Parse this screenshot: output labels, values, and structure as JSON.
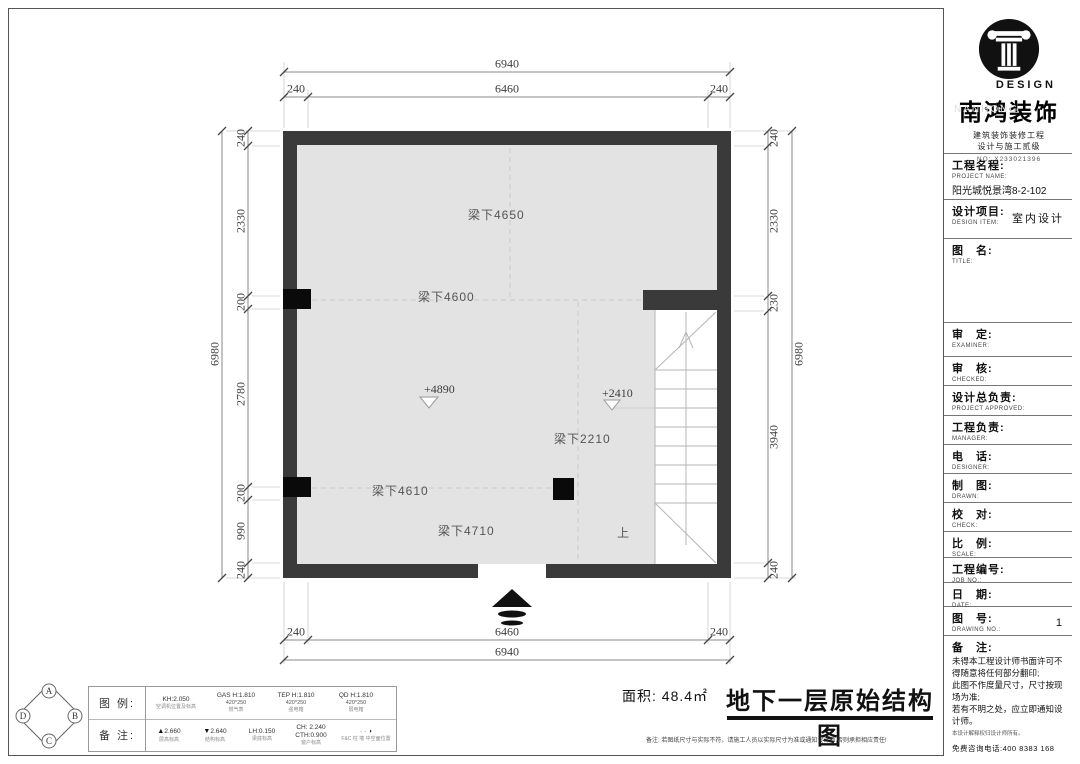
{
  "plan": {
    "beams": {
      "b4650": "梁下4650",
      "b4600": "梁下4600",
      "b2210": "梁下2210",
      "b4610": "梁下4610",
      "b4710": "梁下4710"
    },
    "elevations": {
      "e4890": "+4890",
      "e2410": "+2410"
    },
    "stair_up": "上",
    "dims": {
      "top": {
        "overall": "6940",
        "parts": [
          "240",
          "6460",
          "240"
        ]
      },
      "bottom": {
        "overall": "6940",
        "parts": [
          "240",
          "6460",
          "240"
        ]
      },
      "left": {
        "overall": "6980",
        "parts": [
          "240",
          "2330",
          "200",
          "2780",
          "200",
          "990",
          "240"
        ]
      },
      "right": {
        "overall": "6980",
        "parts": [
          "240",
          "2330",
          "230",
          "3940",
          "240"
        ]
      }
    },
    "colors": {
      "wall": "#3a3a3a",
      "floor": "#e3e3e3"
    }
  },
  "axis_marker": {
    "top": "A",
    "right": "B",
    "bottom": "C",
    "left": "D"
  },
  "legend": {
    "row1_label": "图 例:",
    "row2_label": "备 注:",
    "items_row1": [
      {
        "value": "KH:2.050",
        "size": "",
        "caption": "空调机位置及标高"
      },
      {
        "value": "GAS H:1.810",
        "size": "420*250",
        "caption": "燃气表"
      },
      {
        "value": "TEP H:1.810",
        "size": "420*250",
        "caption": "强电箱"
      },
      {
        "value": "QD H:1.810",
        "size": "420*250",
        "caption": "弱电箱"
      }
    ],
    "items_row2": [
      {
        "icon": "▲",
        "value": "2.660",
        "caption": "层高标高"
      },
      {
        "icon": "▼",
        "value": "2.640",
        "caption": "结构标高"
      },
      {
        "icon": "",
        "value": "LH:0.150",
        "caption": "梁底标高"
      },
      {
        "icon": "",
        "value": "CH: 2.240",
        "value2": "CTH:0.900",
        "caption": "窗户标高"
      },
      {
        "icon": "◑",
        "value": "· ·",
        "caption": "F&C 柱 墙 中空面位置"
      }
    ]
  },
  "footer": {
    "area": "面积: 48.4㎡",
    "title": "地下一层原始结构图",
    "note": "备注: 若图纸尺寸与实际不符，请施工人员以实际尺寸为准或通知设计师,否则承担相应责任!"
  },
  "titleblock": {
    "brand": {
      "design": "DESIGN",
      "watermark": "NANHONG",
      "name": "南鸿装饰",
      "sub1": "建筑装饰装修工程",
      "sub2": "设计与施工贰级",
      "cert": "NO: X233021396"
    },
    "project_name": {
      "zh": "工程名程:",
      "en": "PROJECT NAME:",
      "value": "阳光城悦景湾8-2-102"
    },
    "design_item": {
      "zh": "设计项目:",
      "en": "DESIGN ITEM:",
      "value": "室内设计"
    },
    "fields": [
      {
        "zh": "图　名:",
        "en": "TITLE:"
      },
      {
        "zh": "审　定:",
        "en": "EXAMINER:"
      },
      {
        "zh": "审　核:",
        "en": "CHECKED:"
      },
      {
        "zh": "设计总负责:",
        "en": "PROJECT APPROVED:"
      },
      {
        "zh": "工程负责:",
        "en": "MANAGER:"
      },
      {
        "zh": "电　话:",
        "en": "DESIGNER:"
      },
      {
        "zh": "制　图:",
        "en": "DRAWN:"
      },
      {
        "zh": "校　对:",
        "en": "CHECK:"
      },
      {
        "zh": "比　例:",
        "en": "SCALE:"
      },
      {
        "zh": "工程编号:",
        "en": "JOB NO.:"
      },
      {
        "zh": "日　期:",
        "en": "DATE:"
      },
      {
        "zh": "图　号:",
        "en": "DRAWING NO.:",
        "value": "1"
      }
    ],
    "remark": {
      "zh": "备　注:",
      "lines": [
        "未得本工程设计师书面许可不得随意将任何部分翻印;",
        "此图不作度量尺寸，尺寸按现场为准;",
        "若有不明之处，应立即通知设计师。"
      ],
      "tiny": "本设计解释权归设计师所有。",
      "phone": "免费咨询电话:400 8383 168"
    }
  }
}
